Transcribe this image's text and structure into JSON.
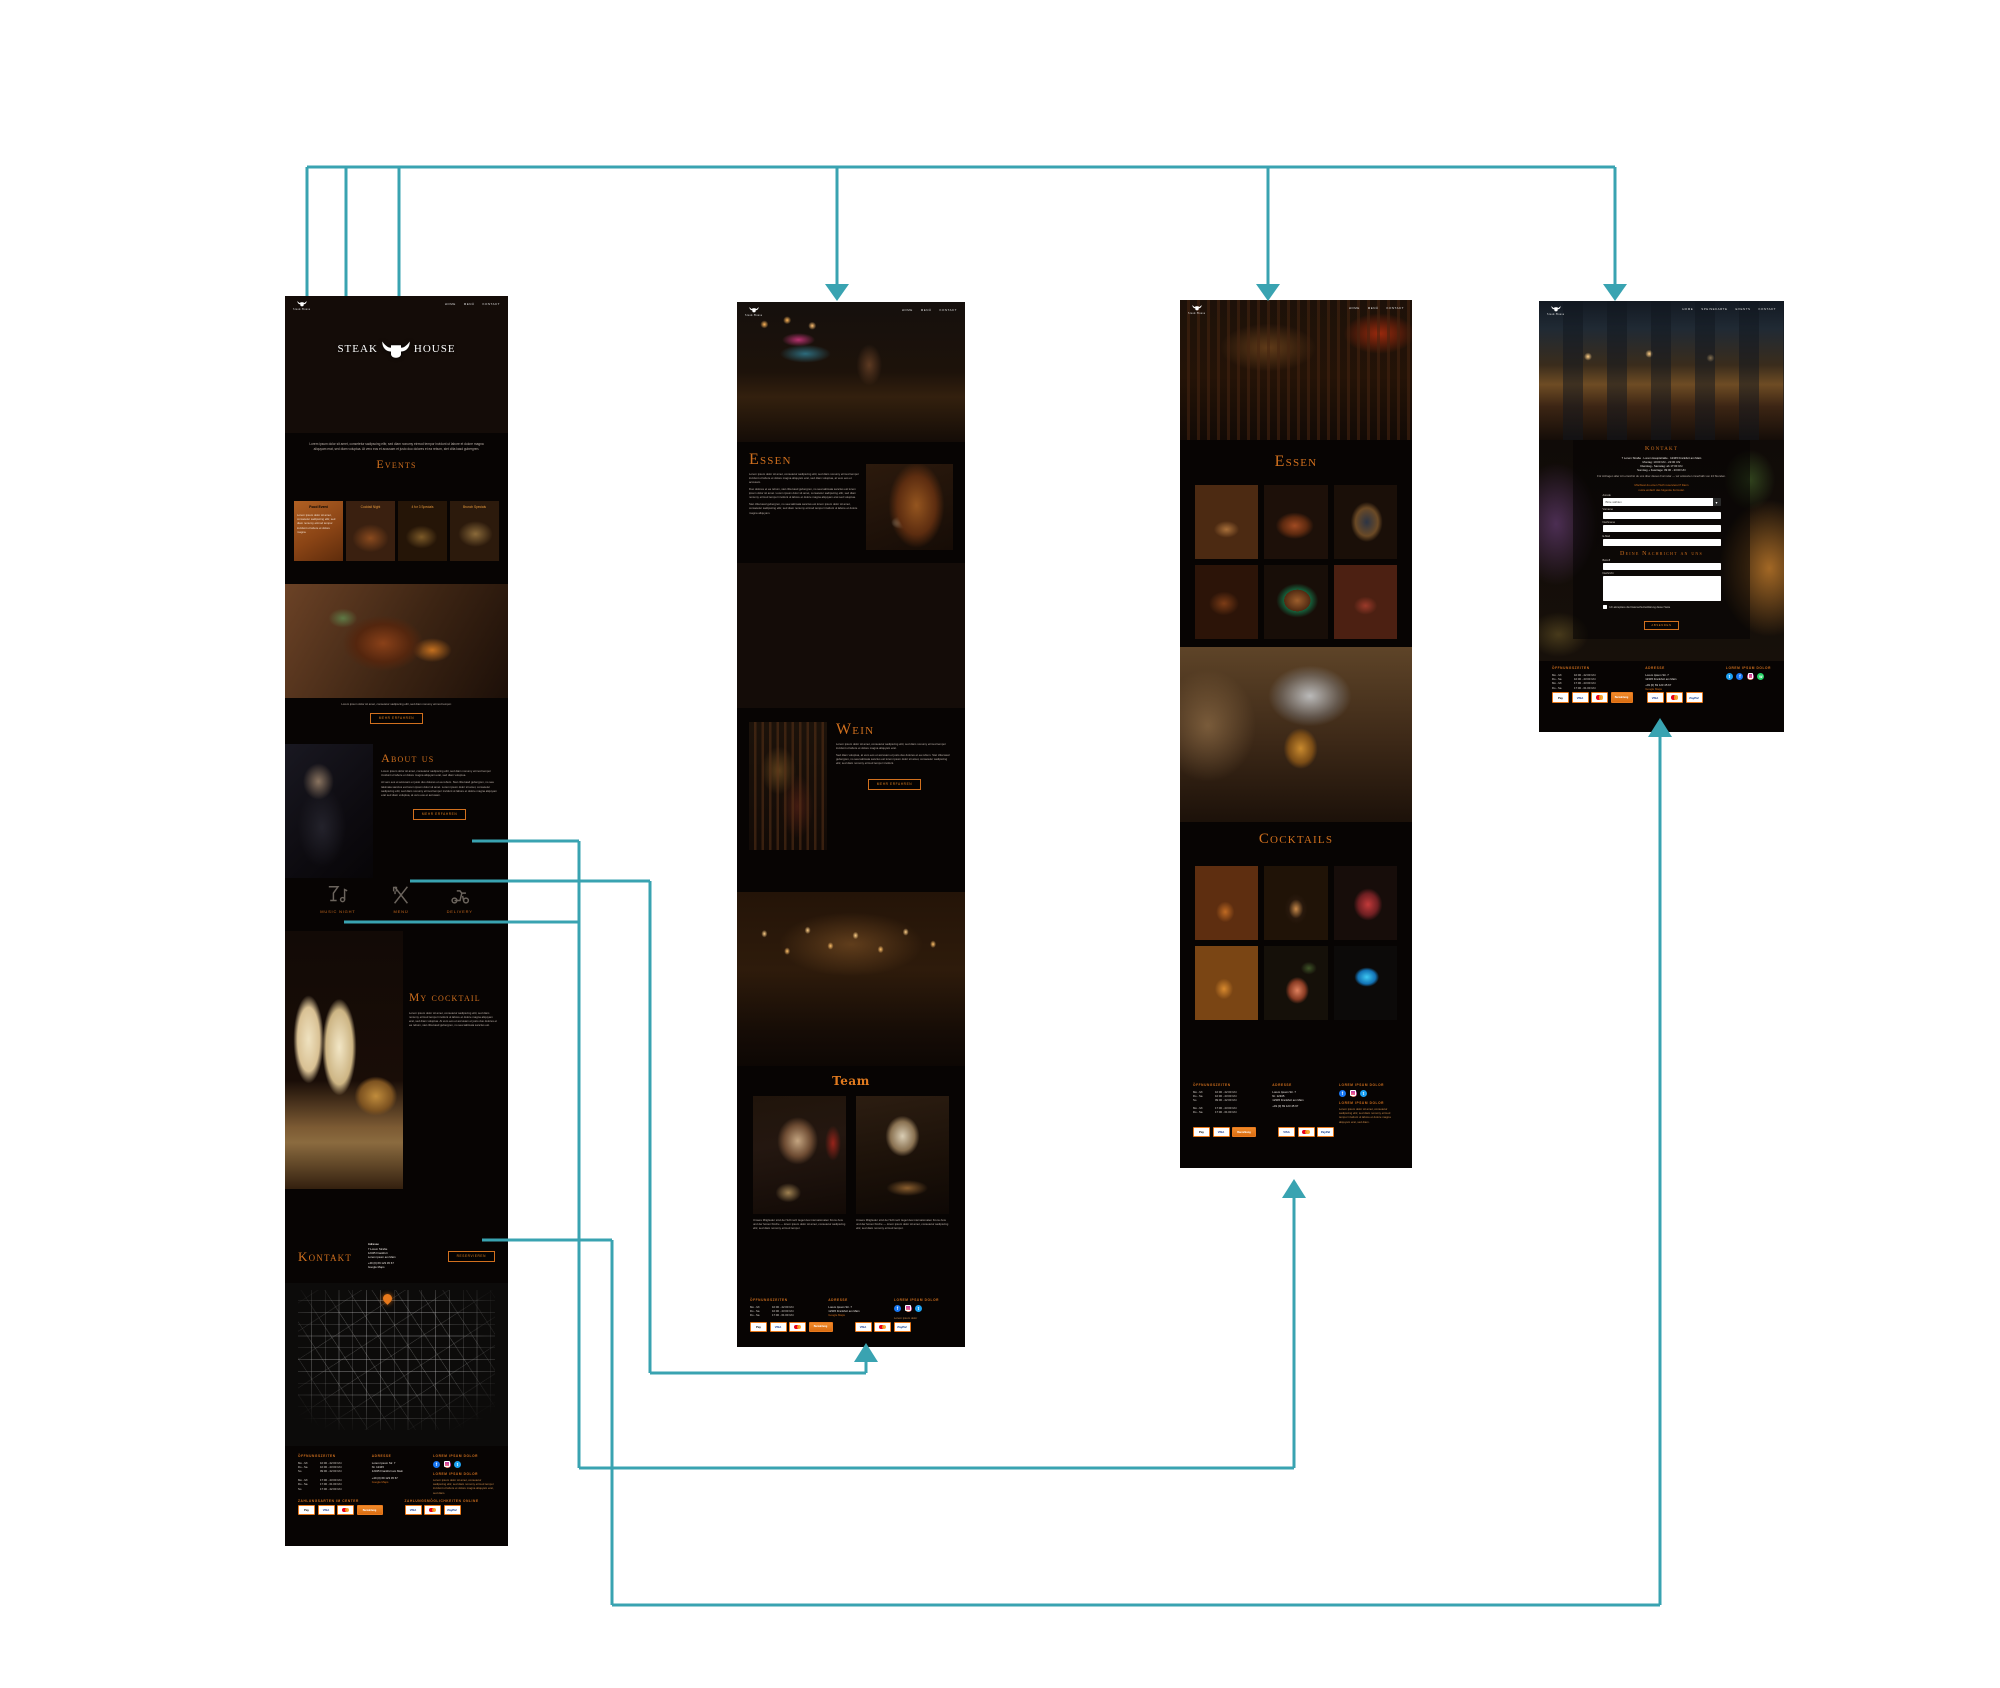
{
  "brand": {
    "name": "Steak House",
    "logo_left": "STEAK",
    "logo_right": "HOUSE",
    "accent": "#d1701e",
    "connector_color": "#39a3b1"
  },
  "nav": {
    "items": [
      "Home",
      "Menü",
      "Kontakt"
    ],
    "items4": [
      "Home",
      "Speisekarte",
      "Events",
      "Kontakt"
    ]
  },
  "home": {
    "intro": "Lorem ipsum dolor sit amet, consetetur sadipscing elitr, sed diam nonumy eirmod tempor invidunt ut labore et dolore magna aliquyam erat, sed diam voluptua. At vero eos et accusam et justo duo dolores et ea rebum, stet clita kasd gubergren.",
    "events": {
      "title": "Events",
      "cards": [
        {
          "title": "Food Event",
          "text": "Lorem ipsum dolor sit amet, consetetur sadipscing elitr, sed diam nonumy eirmod tempor invidunt ut labore et dolore magna."
        },
        {
          "title": "Cocktail Night"
        },
        {
          "title": "4 for 3 Specials"
        },
        {
          "title": "Brunch Specials"
        }
      ]
    },
    "steak": {
      "caption": "Lorem ipsum dolor sit amet, consetetur sadipscing elitr, sed diam nonumy eirmod tempor.",
      "button": "Mehr erfahren"
    },
    "about": {
      "title": "About us",
      "p1": "Lorem ipsum dolor sit amet, consetetur sadipscing elitr, sed diam nonumy eirmod tempor invidunt ut labore et dolore magna aliquyam erat, sed diam voluptua.",
      "p2": "At vero eos et accusam et justo duo dolores et ea rebum. Stet clita kasd gubergren, no sea takimata sanctus est lorem ipsum dolor sit amet. Lorem ipsum dolor sit amet, consetetur sadipscing elitr, sed diam nonumy eirmod tempor invidunt ut labore et dolore magna aliquyam erat sed diam voluptua, at vero eos et accusam.",
      "button": "Mehr erfahren"
    },
    "features": [
      {
        "label": "Music Night"
      },
      {
        "label": "Menü"
      },
      {
        "label": "Delivery"
      }
    ],
    "cocktail": {
      "title": "My cocktail",
      "text": "Lorem ipsum dolor sit amet, consetetur sadipscing elitr, sed diam nonumy eirmod tempor invidunt ut labore et dolore magna aliquyam erat, sed diam voluptua. At vero eos et accusam et justo duo dolores et ea rebum, stet clita kasd gubergren, no sea takimata sanctus est."
    },
    "kontakt": {
      "title": "Kontakt",
      "lines": [
        "Adresse",
        "7 Lorem Straße",
        "12345 Frankfurt",
        "Lorem ipsum am Main",
        "+49 (0) 69 123 45 67",
        "Google Maps"
      ],
      "button": "Reservieren"
    }
  },
  "essen_page": {
    "essen": {
      "title": "Essen",
      "p1": "Lorem ipsum dolor sit amet, consetetur sadipscing elitr, sed diam nonumy eirmod tempor invidunt ut labore et dolore magna aliquyam erat, sed diam voluptua, at vero eos et accusam.",
      "p2": "Duo dolores et ea rebum, stet clita kasd gubergren, no sea takimata sanctus est lorem ipsum dolor sit amet. Lorem ipsum dolor sit amet, consetetur sadipscing elitr, sed diam nonumy eirmod tempor invidunt ut labore et dolore magna aliquyam erat sed voluptua.",
      "p3": "Stet clita kasd gubergren, no sea takimata sanctus est lorem ipsum dolor sit amet, consetetur sadipscing elitr, sed diam nonumy eirmod tempor invidunt ut labore et dolore magna aliquyam."
    },
    "wein": {
      "title": "Wein",
      "p1": "Lorem ipsum dolor sit amet, consetetur sadipscing elitr, sed diam nonumy eirmod tempor invidunt ut labore et dolore magna aliquyam erat.",
      "p2": "Sed diam voluptua, at vero eos et accusam et justo duo dolores et ea rebum. Stet clita kasd gubergren, no sea takimata sanctus est lorem ipsum dolor sit amet, consetetur sadipscing elitr, sed diam nonumy eirmod tempor invidunt.",
      "button": "Mehr erfahren"
    },
    "team": {
      "title": "Team",
      "caption": "Unsere Mitglieder sind der Schmelz tiegel des internationalen Know-how und der feinen Küche — lorem ipsum dolor sit amet, consetetur sadipscing elitr, sed diam nonumy eirmod tempor."
    }
  },
  "cocktails_page": {
    "essen_title": "Essen",
    "cocktails_title": "Cocktails"
  },
  "kontakt_page": {
    "title": "Kontakt",
    "address": "7 Lorem Straße · Lorem Hauptstraße · 12345 Frankfurt am Main",
    "hours1": "Montag: 10:00 Uhr - 22:00 Uhr",
    "hours2": "Dienstag - Samstag: ab 17:00 Uhr",
    "hours3": "Sonntag + Feiertage: 09:00 - 23:00 Uhr",
    "note": "Für Anfragen aller Art erreichst du uns über dieses Formular — wir antworten innerhalb von 24 Stunden.",
    "prompt_1": "Möchtest du einen Tisch reservieren? Dann",
    "prompt_2": "nutze einfach das folgende Formular.",
    "form": {
      "anrede_label": "Anrede",
      "anrede_value": "Bitte wählen",
      "field1": "Vorname",
      "field2": "Nachname",
      "field3": "E-Mail",
      "message_title": "Deine Nachricht an uns",
      "subject_label": "Betreff",
      "message_label": "Nachricht",
      "checkbox": "Ich akzeptiere die Datenschutzerklärung dieser Seite",
      "send": "Absenden"
    }
  },
  "footer": {
    "hours_title": "Öffnungszeiten",
    "hours1": [
      [
        "Mo - Mi",
        "10:00 - 22:00 Uhr"
      ],
      [
        "Do - Sa",
        "10:00 - 23:00 Uhr"
      ],
      [
        "So",
        "09:00 - 22:00 Uhr"
      ]
    ],
    "hours2": [
      [
        "Mo - Mi",
        "17:00 - 23:00 Uhr"
      ],
      [
        "Do - Sa",
        "17:00 - 01:00 Uhr"
      ],
      [
        "So",
        "17:00 - 22:00 Uhr"
      ]
    ],
    "address_title": "Adresse",
    "address1": "Lorem Ipsum Str. 7",
    "address2": "Nr. 12345",
    "address3": "12345 Frankfurt am Main",
    "phone": "+49 (0) 69 123 45 67",
    "maps": "Google Maps",
    "social_title": "Lorem ipsum dolor",
    "about_title": "Lorem ipsum dolor",
    "about_text": "Lorem ipsum dolor sit amet, consetetur sadipscing elitr, sed diam nonumy eirmod tempor invidunt ut labore et dolore magna aliquyam erat, sed diam.",
    "pay_center_title": "Zahlungsarten im Center",
    "pay_online_title": "Zahlungsmöglichkeiten online",
    "chips": {
      "applepay": "Pay",
      "visa": "VISA",
      "paypal": "PayPal",
      "cash": "Barzahlung"
    }
  }
}
